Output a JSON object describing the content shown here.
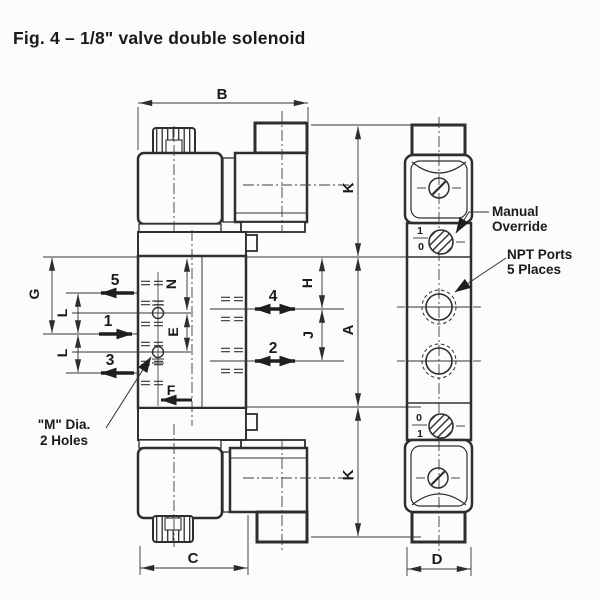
{
  "figure": {
    "title": "Fig. 4 – 1/8\" valve double solenoid"
  },
  "front_view": {
    "dim_b": "B",
    "dim_c": "C",
    "dim_g": "G",
    "dim_l_upper": "L",
    "dim_l_lower": "L",
    "dim_n": "N",
    "dim_e": "E",
    "dim_f": "F",
    "dim_h": "H",
    "dim_j": "J",
    "port_5": "5",
    "port_1": "1",
    "port_3": "3",
    "port_4": "4",
    "port_2": "2",
    "mounting_holes_note": {
      "line1": "\"M\" Dia.",
      "line2": "2 Holes"
    }
  },
  "shared_dims": {
    "dim_k_upper": "K",
    "dim_a": "A",
    "dim_k_lower": "K"
  },
  "side_view": {
    "dim_d": "D",
    "manual_override_label": {
      "line1": "Manual",
      "line2": "Override"
    },
    "npt_ports_label": {
      "line1": "NPT Ports",
      "line2": "5 Places"
    },
    "override_top": {
      "pos_1": "1",
      "pos_0": "0"
    },
    "override_bottom": {
      "pos_0": "0",
      "pos_1": "1"
    }
  },
  "colors": {
    "line": "#2e2e2e",
    "text": "#1a1a1a",
    "background": "#fcfcfa"
  }
}
